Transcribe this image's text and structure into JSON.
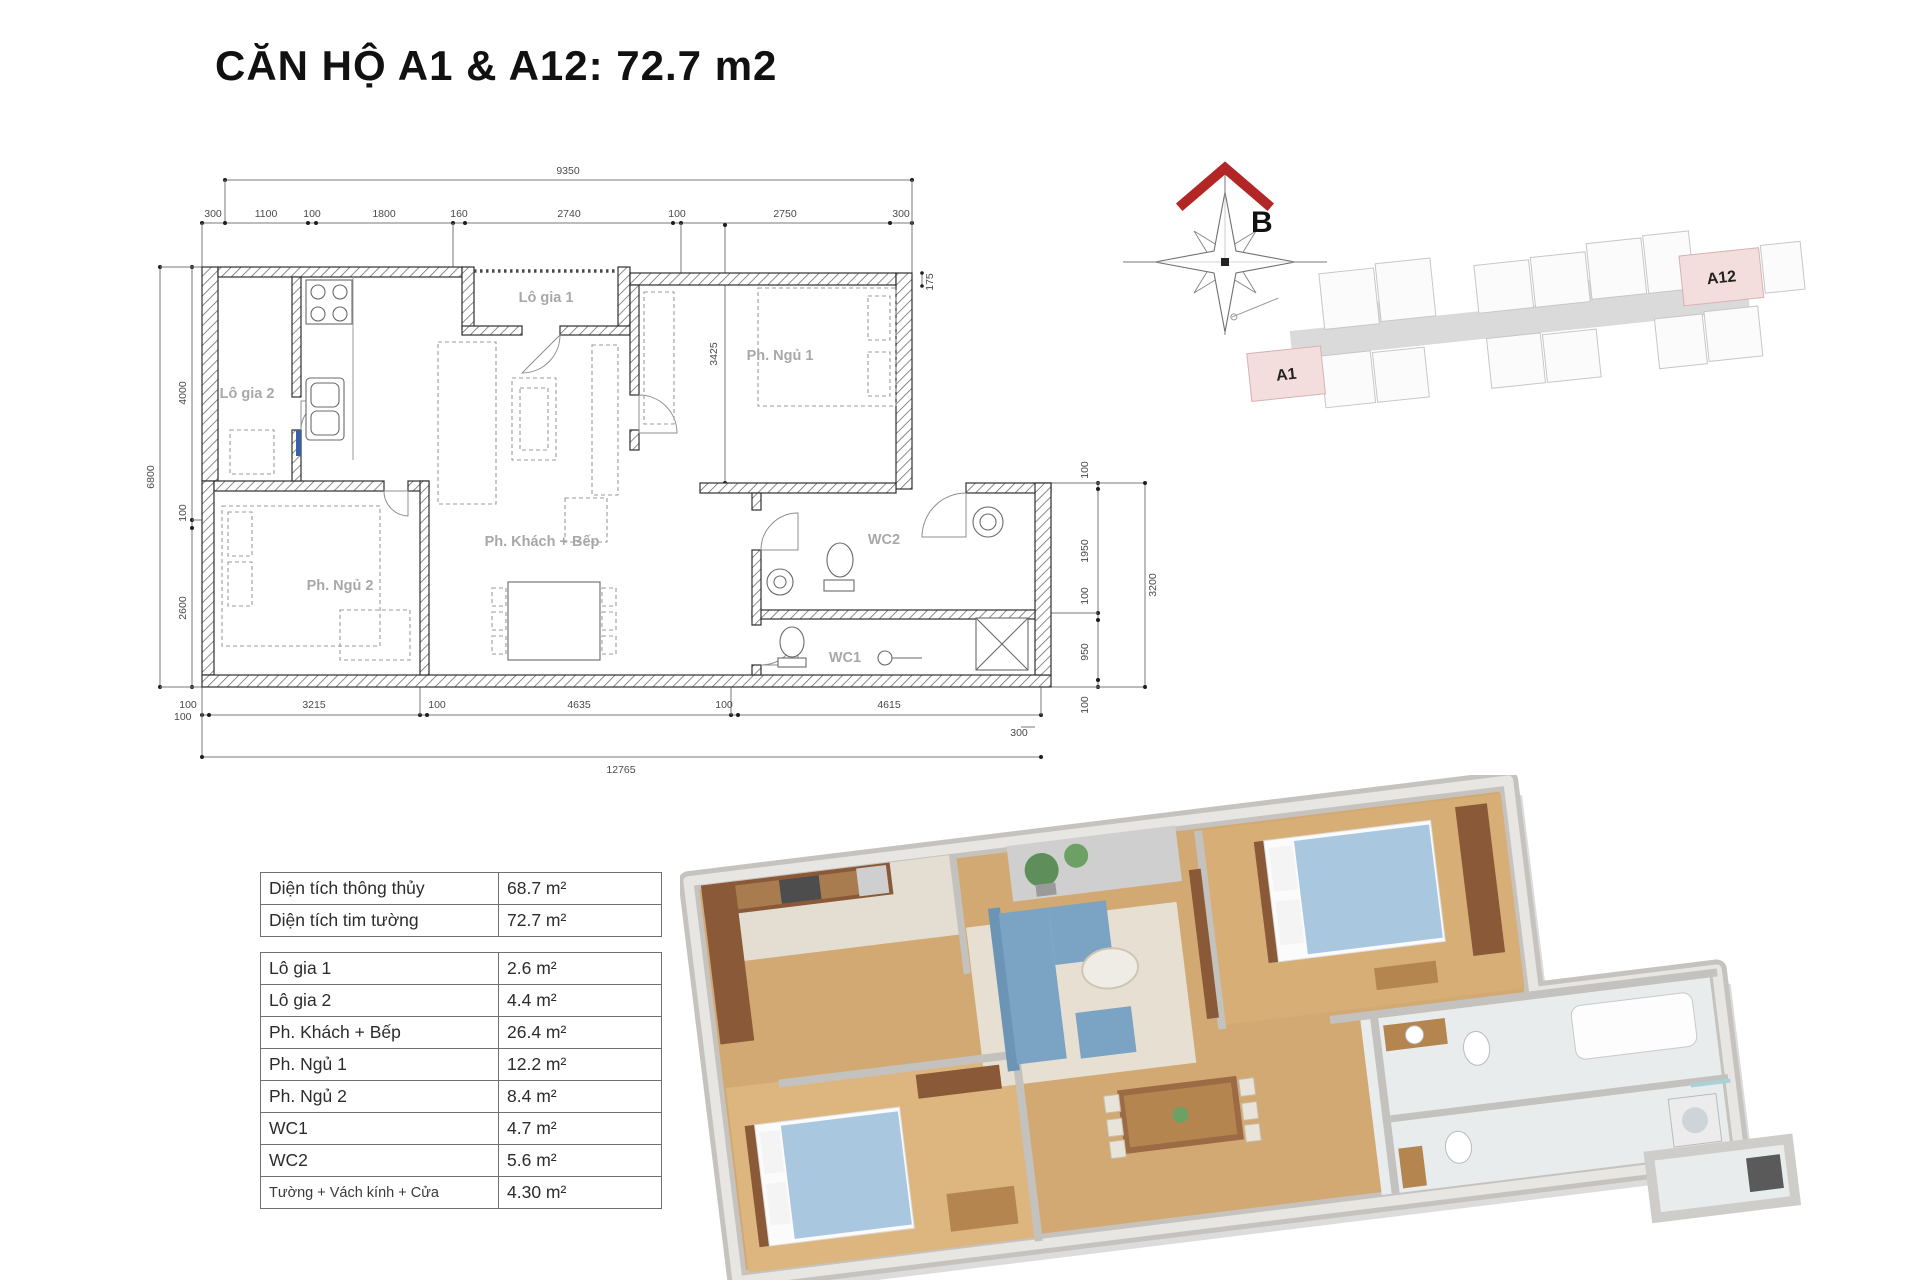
{
  "title": "CĂN HỘ A1 & A12: 72.7 m2",
  "plan": {
    "rooms": {
      "logia1": "Lô gia 1",
      "logia2": "Lô gia 2",
      "ngu1": "Ph. Ngủ 1",
      "ngu2": "Ph. Ngủ 2",
      "khach": "Ph. Khách + Bếp",
      "wc1": "WC1",
      "wc2": "WC2"
    },
    "dims": {
      "top_total": "9350",
      "top": [
        "300",
        "1100",
        "100",
        "1800",
        "160",
        "2740",
        "100",
        "2750",
        "300"
      ],
      "top_right": "175",
      "left_total": "6800",
      "left": [
        "4000",
        "100",
        "2600"
      ],
      "left_bottom": "100",
      "ngu1_height": "3425",
      "right": [
        "100",
        "1950",
        "100",
        "950",
        "100"
      ],
      "right_total": "3200",
      "right_bottom": "300",
      "bottom": [
        "100",
        "3215",
        "100",
        "4635",
        "100",
        "4615"
      ],
      "bottom_total": "12765"
    }
  },
  "compass": {
    "north_label": "B"
  },
  "key_plan": {
    "units": [
      {
        "label": "A1"
      },
      {
        "label": "A12"
      }
    ],
    "highlight_color": "#f4dddd"
  },
  "area_table": {
    "summary": [
      {
        "label": "Diện tích thông thủy",
        "value": "68.7 m²"
      },
      {
        "label": "Diện tích tim tường",
        "value": "72.7 m²"
      }
    ],
    "details": [
      {
        "label": "Lô gia 1",
        "value": "2.6 m²"
      },
      {
        "label": "Lô gia 2",
        "value": "4.4 m²"
      },
      {
        "label": "Ph. Khách + Bếp",
        "value": "26.4 m²"
      },
      {
        "label": "Ph. Ngủ 1",
        "value": "12.2 m²"
      },
      {
        "label": "Ph. Ngủ 2",
        "value": "8.4 m²"
      },
      {
        "label": "WC1",
        "value": "4.7 m²"
      },
      {
        "label": "WC2",
        "value": "5.6 m²"
      },
      {
        "label": "Tường + Vách kính + Cửa",
        "value": "4.30 m²"
      }
    ]
  },
  "colors": {
    "compass_red": "#b22626",
    "wood_floor": "#d2a972",
    "sofa_blue": "#7aa3c4",
    "blanket_blue": "#a9c7df"
  }
}
